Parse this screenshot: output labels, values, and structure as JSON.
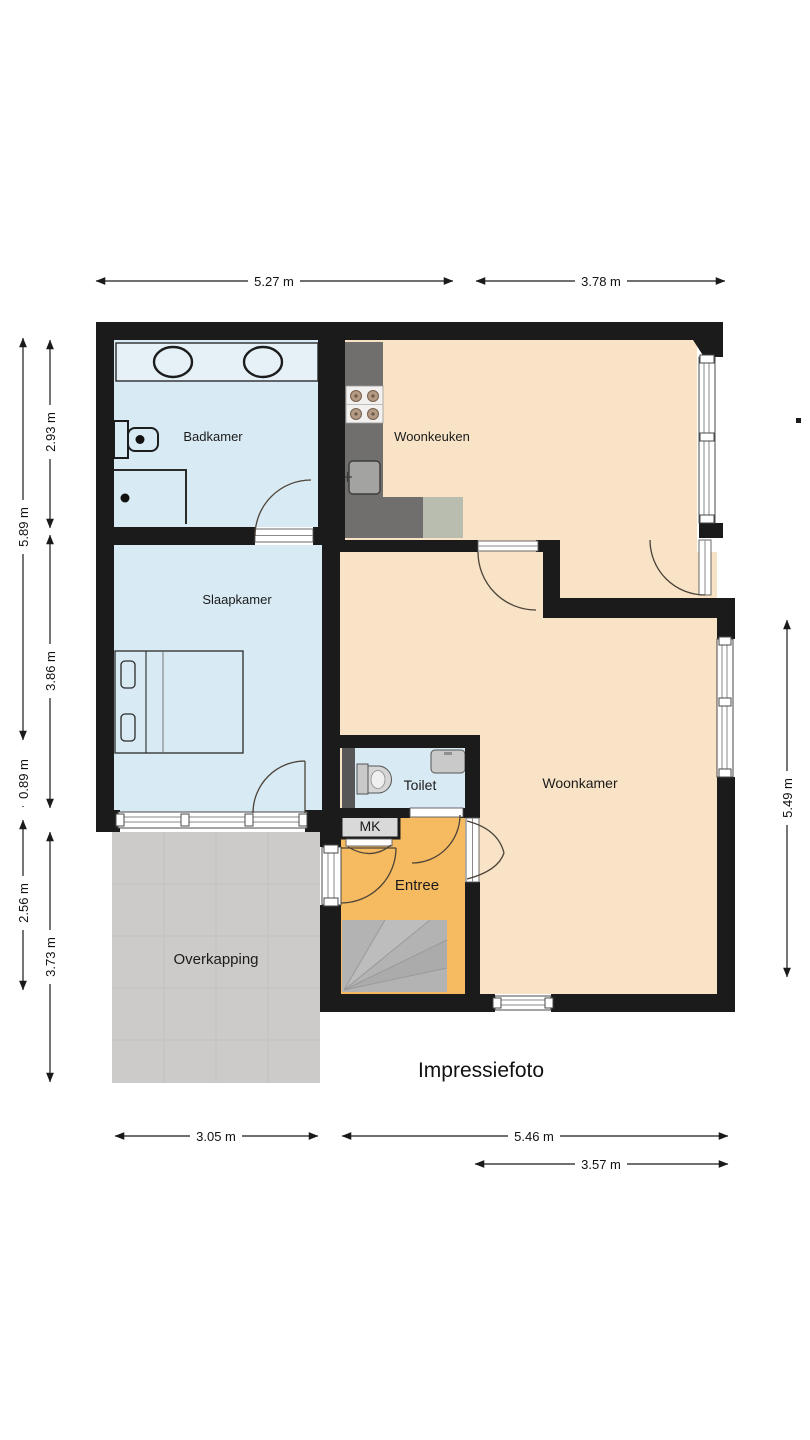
{
  "floorplan": {
    "caption": "Impressiefoto",
    "rooms": {
      "badkamer": "Badkamer",
      "woonkeuken": "Woonkeuken",
      "slaapkamer": "Slaapkamer",
      "toilet": "Toilet",
      "mk": "MK",
      "woonkamer": "Woonkamer",
      "entree": "Entree",
      "overkapping": "Overkapping"
    },
    "dimensions": {
      "top_left": "5.27 m",
      "top_right": "3.78 m",
      "left_outer_upper": "5.89 m",
      "left_outer_middle": "0.89 m",
      "left_outer_lower": "2.56 m",
      "left_inner_upper": "2.93 m",
      "left_inner_middle": "3.86 m",
      "left_inner_lower": "3.73 m",
      "right_side": "5.49 m",
      "bottom_left": "3.05 m",
      "bottom_middle": "5.46 m",
      "bottom_right": "3.57 m"
    },
    "colors": {
      "wall": "#1b1b1b",
      "wet_room_floor": "#d8eaf3",
      "living_floor": "#f8e3c6",
      "entry_floor": "#f6bb60",
      "terrace_floor": "#cccbc9",
      "kitchen_counter": "#716f6d",
      "kitchen_appliance": "#b9bdb0",
      "stairs": "#b3b3b3"
    }
  }
}
